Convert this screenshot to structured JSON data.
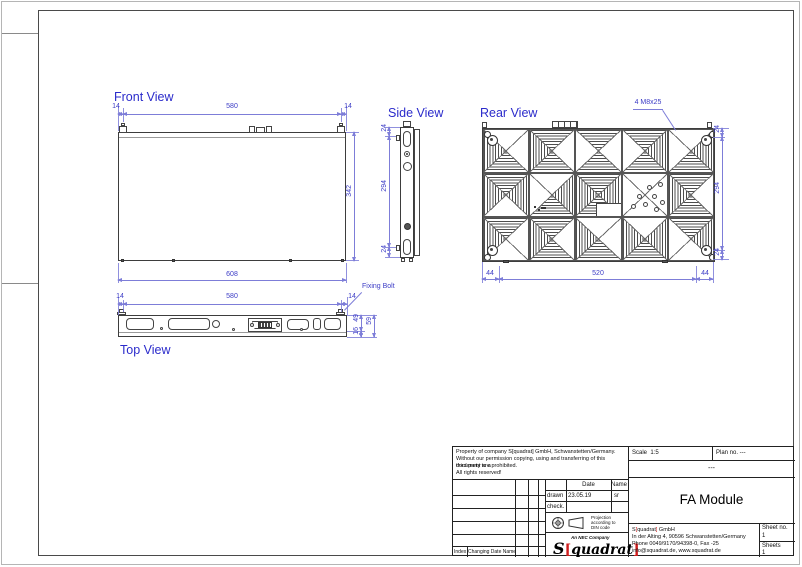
{
  "colors": {
    "dim_blue": "#3c3cc6",
    "line_dark": "#3d3d3d",
    "logo_red": "#cf1d1d"
  },
  "views": {
    "front": {
      "title": "Front View",
      "dims": {
        "top_left": "14",
        "top_center": "580",
        "top_right": "14",
        "height": "342",
        "width_total": "608"
      }
    },
    "side": {
      "title": "Side View",
      "dims": {
        "top": "24",
        "middle": "294",
        "bottom": "24"
      }
    },
    "rear": {
      "title": "Rear View",
      "callout": "4 M8x25",
      "dims": {
        "right_top": "24",
        "right_mid": "294",
        "right_bottom": "24",
        "bottom_left": "44",
        "bottom_mid": "520",
        "bottom_right": "44"
      },
      "cells": [
        {
          "tri": [
            0,
            0,
            1,
            1
          ],
          "feat": "bolt-tl"
        },
        {
          "tri": [
            1,
            0,
            1,
            1
          ],
          "feat": ""
        },
        {
          "tri": [
            1,
            0,
            1,
            0
          ],
          "feat": ""
        },
        {
          "tri": [
            1,
            1,
            1,
            0
          ],
          "feat": ""
        },
        {
          "tri": [
            0,
            1,
            1,
            0
          ],
          "feat": "bolt-tr"
        },
        {
          "tri": [
            1,
            1,
            0,
            1
          ],
          "feat": ""
        },
        {
          "tri": [
            0,
            1,
            1,
            0
          ],
          "feat": "marks"
        },
        {
          "tri": [
            1,
            1,
            1,
            1
          ],
          "feat": "plate"
        },
        {
          "tri": [
            0,
            0,
            0,
            0
          ],
          "feat": "holes"
        },
        {
          "tri": [
            1,
            0,
            1,
            1
          ],
          "feat": ""
        },
        {
          "tri": [
            1,
            0,
            0,
            1
          ],
          "feat": "bolt-bl"
        },
        {
          "tri": [
            1,
            0,
            1,
            1
          ],
          "feat": ""
        },
        {
          "tri": [
            0,
            0,
            1,
            1
          ],
          "feat": ""
        },
        {
          "tri": [
            0,
            1,
            1,
            1
          ],
          "feat": ""
        },
        {
          "tri": [
            1,
            1,
            0,
            0
          ],
          "feat": "bolt-br"
        }
      ]
    },
    "top": {
      "title": "Top View",
      "callout": "Fixing Bolt",
      "dims": {
        "top_left": "14",
        "top_center": "580",
        "top_right": "14",
        "depth_a": "49",
        "depth_b": "16",
        "depth_total": "59"
      }
    }
  },
  "title_block": {
    "property_lines": [
      "Property of company S[quadrat] GmbH, Schwanstetten/Germany.",
      "Without our permission copying, using and transferring of this document to a",
      "third party are prohibited.",
      "All rights reserved!"
    ],
    "scale_label": "Scale",
    "scale_value": "1:5",
    "plan_label": "Plan no. ---",
    "plan_value": "---",
    "drawing_title": "FA Module",
    "date_header": "Date",
    "name_header": "Name",
    "rows": [
      {
        "action": "drawn",
        "date": "23.05.19",
        "name": "sr"
      },
      {
        "action": "check.",
        "date": "",
        "name": ""
      }
    ],
    "projection_note": "Projection according to DIN code",
    "nec_label": "An NEC Company",
    "logo": {
      "s": "S",
      "open": "[",
      "mid": "quadrat",
      "close": "]"
    },
    "company_name": {
      "pre": "S",
      "open": "[",
      "mid": "quadrat",
      "close": "]",
      "post": " GmbH"
    },
    "company_lines": [
      "In der Alting 4, 90596 Schwanstetten/Germany",
      "Phone 0049/9170/94398-0, Fax -25",
      "info@squadrat.de, www.squadrat.de"
    ],
    "sheet_no_label": "Sheet no.",
    "sheet_no_value": "1",
    "sheets_label": "Sheets",
    "sheets_value": "1",
    "index_label": "Index",
    "changing_label": "Changing Date Name"
  }
}
